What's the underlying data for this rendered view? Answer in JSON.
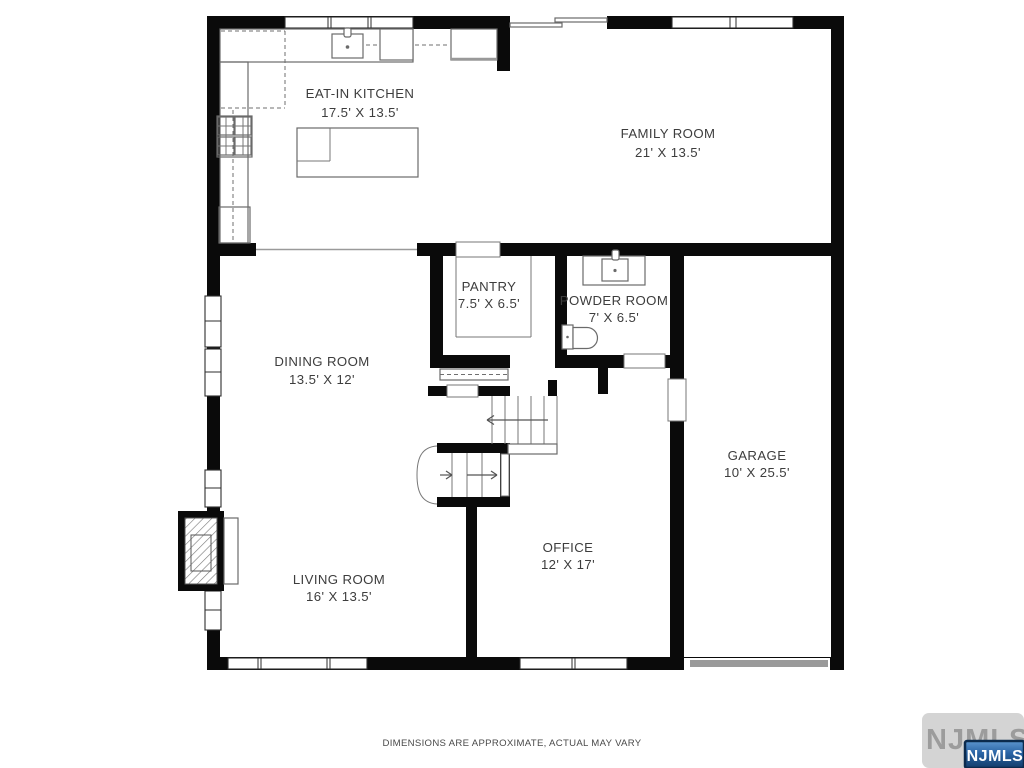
{
  "plan": {
    "rooms": [
      {
        "id": "kitchen",
        "name": "EAT-IN KITCHEN",
        "dims": "17.5' X 13.5'"
      },
      {
        "id": "family",
        "name": "FAMILY ROOM",
        "dims": "21' X 13.5'"
      },
      {
        "id": "pantry",
        "name": "PANTRY",
        "dims": "7.5' X 6.5'"
      },
      {
        "id": "powder",
        "name": "POWDER ROOM",
        "dims": "7' X 6.5'"
      },
      {
        "id": "dining",
        "name": "DINING ROOM",
        "dims": "13.5' X 12'"
      },
      {
        "id": "garage",
        "name": "GARAGE",
        "dims": "10' X 25.5'"
      },
      {
        "id": "office",
        "name": "OFFICE",
        "dims": "12' X 17'"
      },
      {
        "id": "living",
        "name": "LIVING ROOM",
        "dims": "16' X 13.5'"
      }
    ],
    "disclaimer": "DIMENSIONS ARE APPROXIMATE, ACTUAL MAY VARY",
    "watermark": "NJMLS",
    "badge": "NJMLS",
    "colors": {
      "wall": "#0a0a0a",
      "fixture_line": "#6a6a6a",
      "label_text": "#3d3d3d",
      "garage_door": "#9a9a9a",
      "badge_blue": "#2a64a5",
      "badge_border": "#0b2a4d",
      "watermark_gray": "#9c9c9c"
    }
  }
}
